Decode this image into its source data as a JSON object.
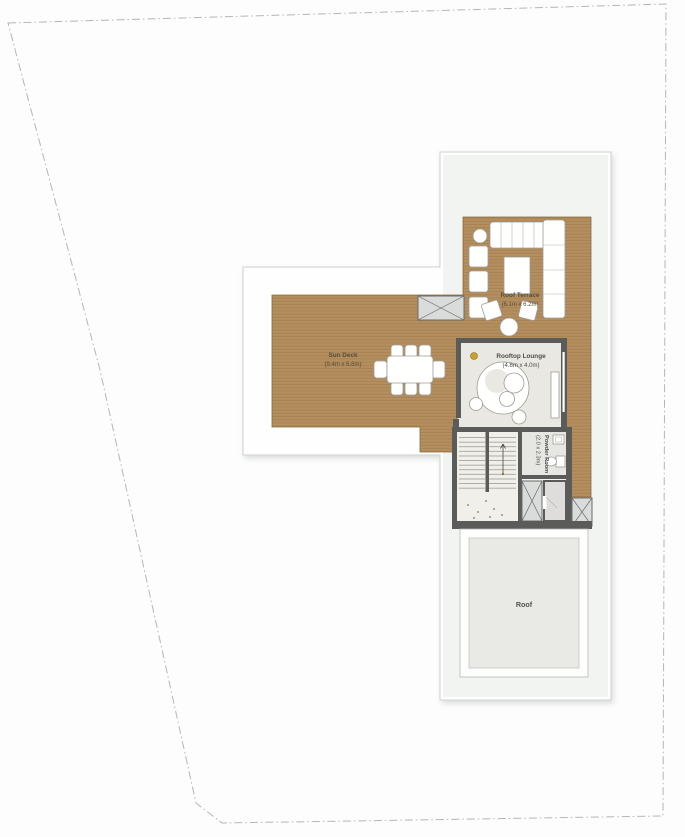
{
  "plan": {
    "areas": {
      "sun_deck": {
        "name": "Sun Deck",
        "dimensions": "(9.4m x 6.6m)"
      },
      "roof_terrace": {
        "name": "Roof Terrace",
        "dimensions": "(6.1m x 6.2m)"
      },
      "rooftop_lounge": {
        "name": "Rooftop Lounge",
        "dimensions": "(4.8m x 4.0m)"
      },
      "powder_room": {
        "name": "Powder Room",
        "dimensions": "(2.0 x 2.3m)"
      },
      "roof": {
        "name": "Roof"
      }
    },
    "colors": {
      "deck_wood": "#b48e5f",
      "deck_plank": "#97743f",
      "wall": "#5b5b59",
      "lounge_floor": "#eae8e2",
      "roof_fill": "#e9e9e5",
      "boundary_line": "#b3b7b5",
      "footprint_fill": "#fdfefd",
      "label_text": "#564e3c"
    }
  }
}
